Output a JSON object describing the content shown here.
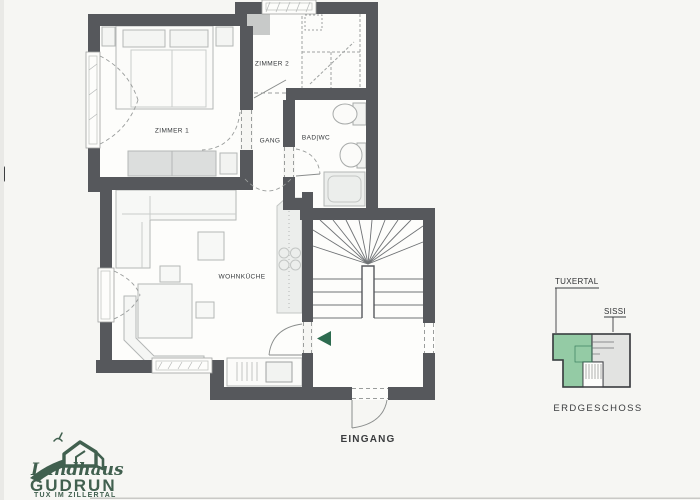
{
  "page": {
    "background_color": "#f6f6f3"
  },
  "floorplan": {
    "rooms": {
      "zimmer1": "ZIMMER 1",
      "zimmer2": "ZIMMER 2",
      "gang": "GANG",
      "bad_wc": "BAD|WC",
      "wohnkueche": "WOHNKÜCHE"
    },
    "entrance_label": "EINGANG",
    "wall_color": "#56585c",
    "entrance_arrow_color": "#2d6b4f"
  },
  "overview_map": {
    "apartment_highlighted": "TUXERTAL",
    "apartment_other": "SISSI",
    "floor_label": "ERDGESCHOSS",
    "highlight_color": "#94cba5",
    "other_color": "#e2e3e1"
  },
  "logo": {
    "script_line": "Landhaus",
    "name_line": "GUDRUN",
    "tagline": "TUX IM ZILLERTAL",
    "color": "#41604f"
  }
}
